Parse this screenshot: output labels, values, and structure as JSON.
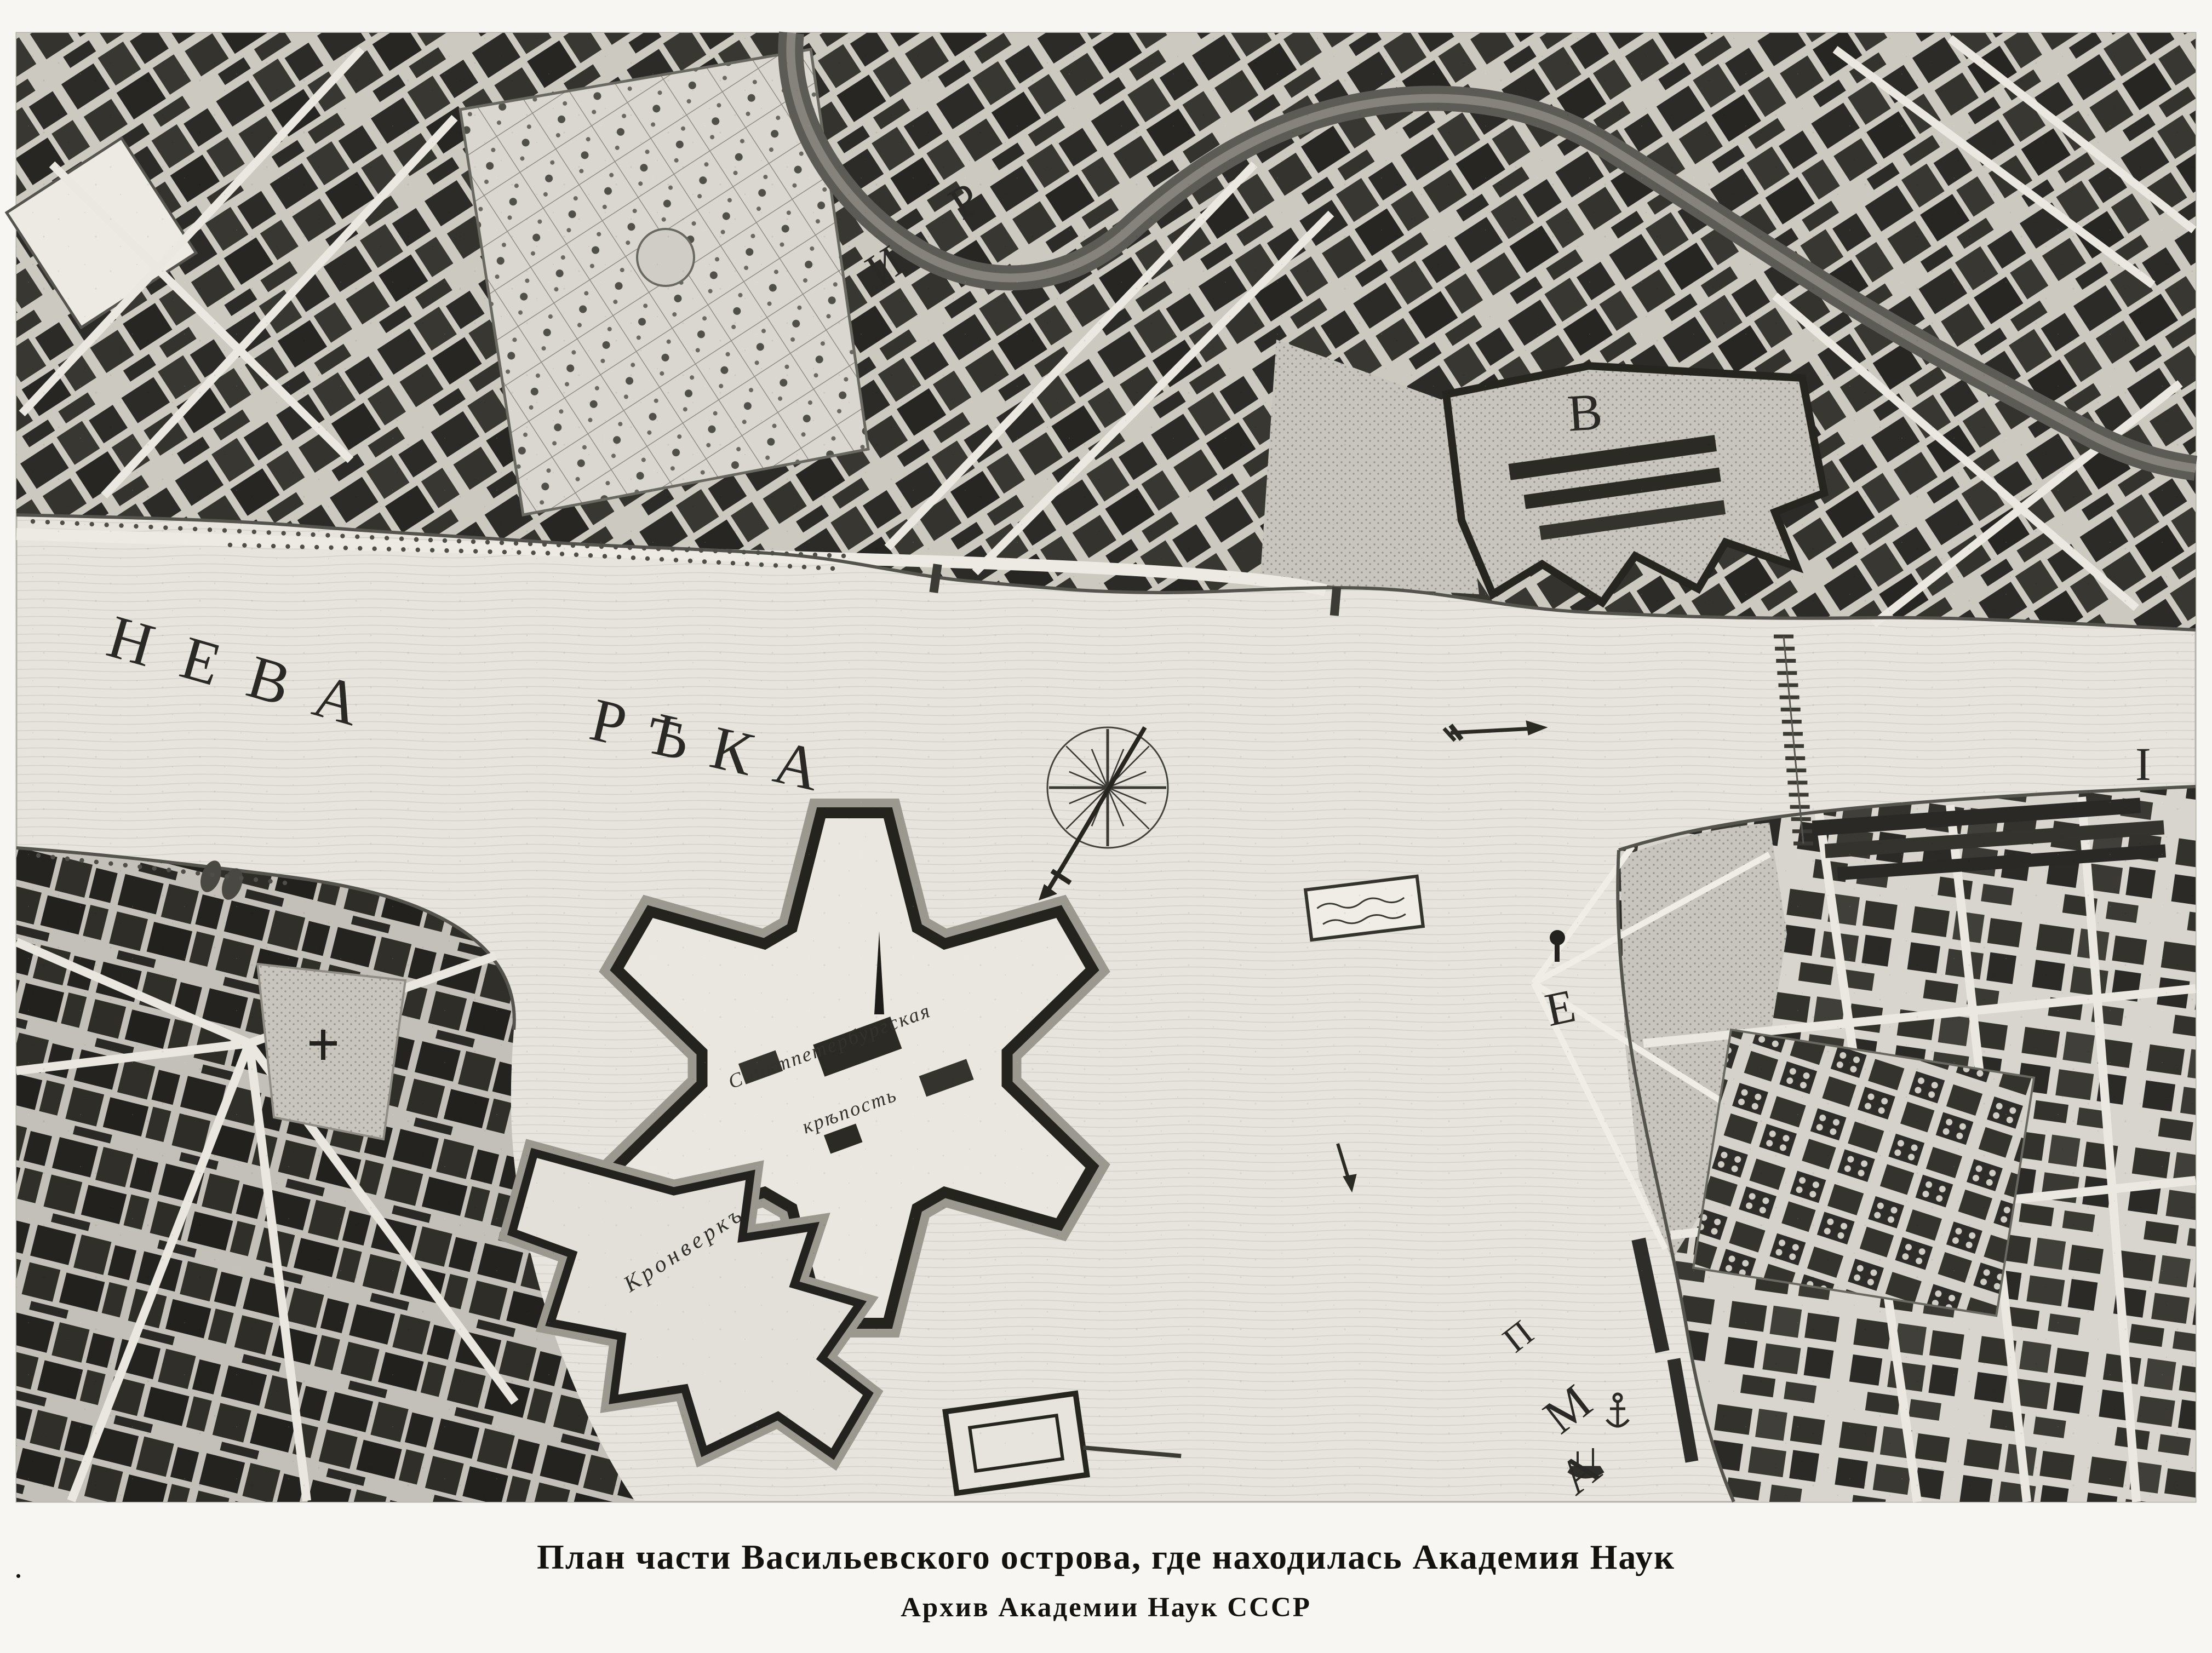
{
  "figure": {
    "caption_line1": "План части Васильевского острова, где находилась Академия Наук",
    "caption_line2": "Архив Академии Наук СССР",
    "stray_mark": "."
  },
  "map": {
    "river_label": {
      "word1": "НЕВА",
      "word2": "РѢКА"
    },
    "index_letters": {
      "letter_v": "В",
      "letter_e": "Е",
      "letter_i": "I",
      "letter_p": "П",
      "letter_m": "М",
      "letter_a": "А",
      "letter_i_street": "И",
      "letter_r_street": "Р"
    },
    "place_labels": {
      "kronverk": "Кронверкъ",
      "fortress_line1": "Санктпетербургская",
      "fortress_line2": "крѣпость"
    },
    "icons": {
      "compass_rose": "16-point compass rose",
      "flow_arrow": "river flow arrow",
      "anchor": "anchor symbol",
      "ship": "sailing ship symbol",
      "bridge": "pontoon bridge"
    },
    "colors": {
      "paper_margin": "#f7f6f3",
      "water": "#e6e4dd",
      "land": "#d2d0c8",
      "ink": "#23221e"
    }
  }
}
